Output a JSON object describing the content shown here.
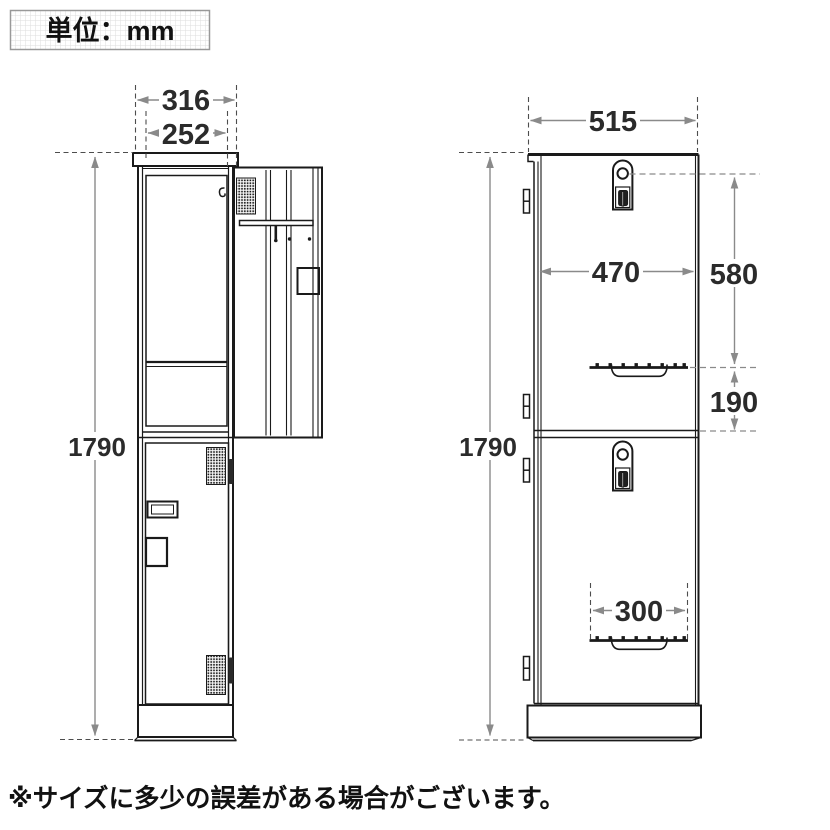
{
  "unit_box": {
    "label": "単位：mm"
  },
  "note": "※サイズに多少の誤差がある場合がございます。",
  "views": {
    "front": {
      "dimensions": {
        "outer_width_mm": "316",
        "door_width_mm": "252",
        "height_mm": "1790"
      }
    },
    "side": {
      "dimensions": {
        "depth_mm": "515",
        "door_inner_depth_mm": "470",
        "upper_door_height_mm": "580",
        "handle_to_divider_mm": "190",
        "height_mm": "1790",
        "handle_width_mm": "300"
      }
    }
  },
  "colors": {
    "outline": "#1a1a1a",
    "dimension_line": "#8a8a8a",
    "dimension_text": "#2b2b2b",
    "grid_line": "#dedede",
    "background": "#ffffff"
  }
}
